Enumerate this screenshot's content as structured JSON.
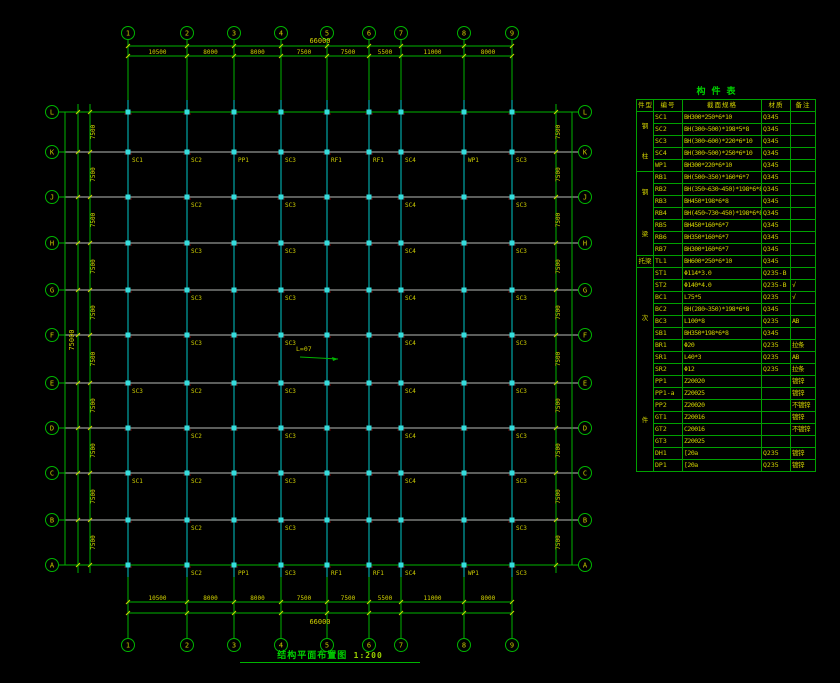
{
  "plan": {
    "title": "结构平面布置图",
    "scale": "1:200",
    "center_note": "L=07",
    "top_axis": [
      "1",
      "2",
      "3",
      "4",
      "5",
      "6",
      "7",
      "8",
      "9"
    ],
    "bottom_axis": [
      "1",
      "2",
      "3",
      "4",
      "5",
      "6",
      "7",
      "8",
      "9"
    ],
    "left_axis": [
      "L",
      "K",
      "J",
      "H",
      "G",
      "F",
      "E",
      "D",
      "C",
      "B",
      "A"
    ],
    "right_axis": [
      "L",
      "K",
      "J",
      "H",
      "G",
      "F",
      "E",
      "D",
      "C",
      "B",
      "A"
    ],
    "dims": {
      "top_total": "66000",
      "bottom_total": "66000",
      "left_total": "75000",
      "top_segments": [
        "10500",
        "8000",
        "8000",
        "7500",
        "7500",
        "5500",
        "11000",
        "8000"
      ],
      "bottom_segments": [
        "10500",
        "8000",
        "8000",
        "7500",
        "7500",
        "5500",
        "11000",
        "8000"
      ],
      "left_segments": [
        "7500",
        "7500",
        "7500",
        "7500",
        "7500",
        "7500",
        "7500",
        "7500",
        "7500",
        "7500"
      ],
      "right_segments": [
        "7500",
        "7500",
        "7500",
        "7500",
        "7500",
        "7500",
        "7500",
        "7500",
        "7500",
        "7500"
      ]
    },
    "member_labels": [
      {
        "row": "K",
        "items": [
          [
            "1",
            "SC1"
          ],
          [
            "2",
            "SC2"
          ],
          [
            "3",
            "PP1"
          ],
          [
            "4",
            "SC3"
          ],
          [
            "5",
            "RF1"
          ],
          [
            "6",
            "RF1"
          ],
          [
            "7",
            "SC4"
          ],
          [
            "8",
            "WP1"
          ],
          [
            "9",
            "SC3"
          ]
        ]
      },
      {
        "row": "J",
        "items": [
          [
            "2",
            "SC2"
          ],
          [
            "4",
            "SC3"
          ],
          [
            "7",
            "SC4"
          ],
          [
            "9",
            "SC3"
          ]
        ]
      },
      {
        "row": "H",
        "items": [
          [
            "2",
            "SC3"
          ],
          [
            "4",
            "SC3"
          ],
          [
            "7",
            "SC4"
          ],
          [
            "9",
            "SC3"
          ]
        ]
      },
      {
        "row": "G",
        "items": [
          [
            "2",
            "SC3"
          ],
          [
            "4",
            "SC3"
          ],
          [
            "7",
            "SC4"
          ],
          [
            "9",
            "SC3"
          ]
        ]
      },
      {
        "row": "F",
        "items": [
          [
            "2",
            "SC3"
          ],
          [
            "4",
            "SC3"
          ],
          [
            "7",
            "SC4"
          ],
          [
            "9",
            "SC3"
          ]
        ]
      },
      {
        "row": "E",
        "items": [
          [
            "1",
            "SC3"
          ],
          [
            "2",
            "SC2"
          ],
          [
            "4",
            "SC3"
          ],
          [
            "7",
            "SC4"
          ],
          [
            "9",
            "SC3"
          ]
        ]
      },
      {
        "row": "D",
        "items": [
          [
            "2",
            "SC2"
          ],
          [
            "4",
            "SC3"
          ],
          [
            "7",
            "SC4"
          ],
          [
            "9",
            "SC3"
          ]
        ]
      },
      {
        "row": "C",
        "items": [
          [
            "1",
            "SC1"
          ],
          [
            "2",
            "SC2"
          ],
          [
            "4",
            "SC3"
          ],
          [
            "7",
            "SC4"
          ],
          [
            "9",
            "SC3"
          ]
        ]
      },
      {
        "row": "B",
        "items": [
          [
            "2",
            "SC2"
          ],
          [
            "4",
            "SC3"
          ],
          [
            "9",
            "SC3"
          ]
        ]
      },
      {
        "row": "A",
        "items": [
          [
            "2",
            "SC2"
          ],
          [
            "3",
            "PP1"
          ],
          [
            "4",
            "SC3"
          ],
          [
            "5",
            "RF1"
          ],
          [
            "6",
            "RF1"
          ],
          [
            "7",
            "SC4"
          ],
          [
            "8",
            "WP1"
          ],
          [
            "9",
            "SC3"
          ]
        ]
      }
    ]
  },
  "table": {
    "title": "构件表",
    "headers": [
      "件型",
      "编号",
      "截面规格",
      "材质",
      "备注"
    ],
    "groups": [
      {
        "category": "钢柱",
        "rows": [
          [
            "SC1",
            "BH300*250*6*10",
            "Q345",
            "",
            ""
          ],
          [
            "SC2",
            "BH(300~500)*198*5*8",
            "Q345",
            "",
            ""
          ],
          [
            "SC3",
            "BH(300~600)*220*6*10",
            "Q345",
            "",
            ""
          ],
          [
            "SC4",
            "BH(300~500)*250*6*10",
            "Q345",
            "",
            ""
          ],
          [
            "WP1",
            "BH300*220*6*10",
            "Q345",
            "",
            ""
          ]
        ]
      },
      {
        "category": "钢梁",
        "rows": [
          [
            "RB1",
            "BH(500~350)*160*6*7",
            "Q345",
            "",
            ""
          ],
          [
            "RB2",
            "BH(350~630~450)*198*6*8",
            "Q345",
            "",
            ""
          ],
          [
            "RB3",
            "BH450*198*6*8",
            "Q345",
            "",
            ""
          ],
          [
            "RB4",
            "BH(450~730~450)*198*6*8",
            "Q345",
            "",
            ""
          ],
          [
            "RB5",
            "BH450*160*6*7",
            "Q345",
            "",
            ""
          ],
          [
            "RB6",
            "BH350*160*6*7",
            "Q345",
            "",
            ""
          ],
          [
            "RB7",
            "BH300*160*6*7",
            "Q345",
            "",
            ""
          ]
        ]
      },
      {
        "category": "托梁",
        "rows": [
          [
            "TL1",
            "BH600*250*6*10",
            "Q345",
            "",
            ""
          ]
        ]
      },
      {
        "category": "次件",
        "rows": [
          [
            "ST1",
            "Φ114*3.0",
            "Q235-B",
            "",
            ""
          ],
          [
            "ST2",
            "Φ140*4.0",
            "Q235-B",
            "√",
            "red"
          ],
          [
            "BC1",
            "L75*5",
            "Q235",
            "√",
            "red"
          ],
          [
            "BC2",
            "BH(280~350)*198*6*8",
            "Q345",
            "",
            ""
          ],
          [
            "BC3",
            "L100*8",
            "Q235",
            "AB",
            ""
          ],
          [
            "SB1",
            "BH350*198*6*8",
            "Q345",
            "",
            ""
          ],
          [
            "BR1",
            "Φ20",
            "Q235",
            "拉条",
            ""
          ],
          [
            "SR1",
            "L40*3",
            "Q235",
            "AB",
            ""
          ],
          [
            "SR2",
            "Φ12",
            "Q235",
            "拉条",
            ""
          ],
          [
            "PP1",
            "Z20020",
            "",
            "镀锌",
            ""
          ],
          [
            "PP1-a",
            "Z20025",
            "",
            "镀锌",
            ""
          ],
          [
            "PP2",
            "Z20020",
            "",
            "不镀锌",
            ""
          ],
          [
            "GT1",
            "Z20016",
            "",
            "镀锌",
            ""
          ],
          [
            "GT2",
            "C20016",
            "",
            "不镀锌",
            ""
          ],
          [
            "GT3",
            "Z20025",
            "",
            "",
            ""
          ],
          [
            "DH1",
            "[20a",
            "Q235",
            "镀锌",
            ""
          ],
          [
            "DP1",
            "[20a",
            "Q235",
            "镀锌",
            ""
          ]
        ]
      }
    ]
  },
  "colors": {
    "background": "#000000",
    "axis_green": "#00b400",
    "row_gray": "#b8bcb8",
    "grid_cyan": "#00c8c8",
    "marker_cyan": "#36dcdc",
    "text_yellow": "#d2d200",
    "label_yellow": "#cccc00",
    "table_green": "#00a000",
    "red_mark": "#e03030",
    "dark_red": "#780000",
    "title_green": "#00d000"
  }
}
